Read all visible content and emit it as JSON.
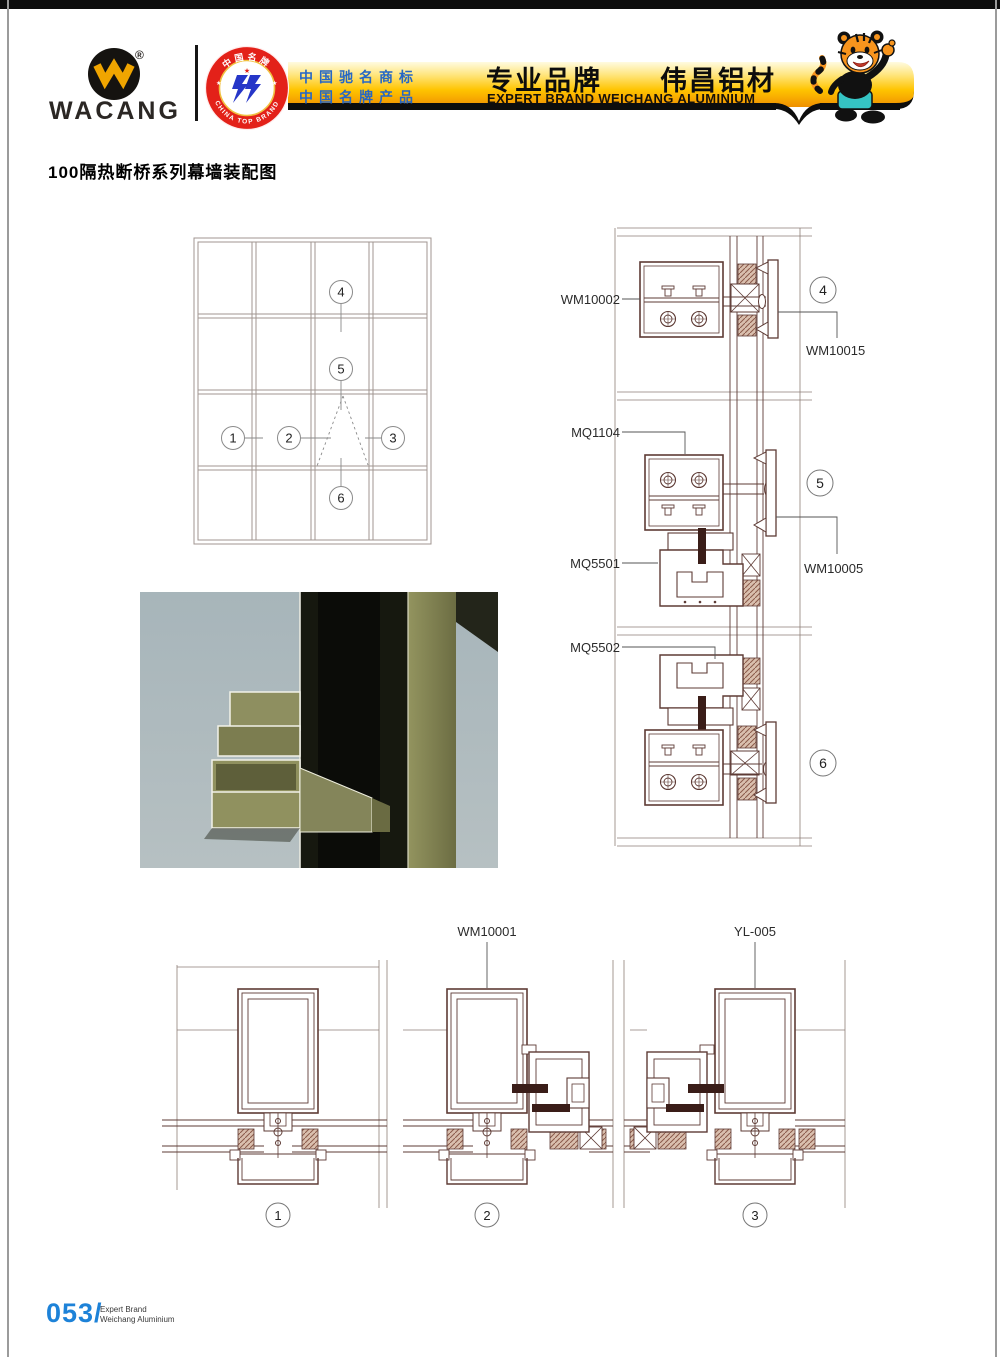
{
  "header": {
    "brand": "WACANG",
    "registered_mark": "®",
    "badge": {
      "arc_top": "中国名牌",
      "arc_bottom": "CHINA TOP BRAND"
    },
    "banner": {
      "trademark_line1": "中国驰名商标",
      "trademark_line2": "中国名牌产品",
      "slogan_cn": "专业品牌　　伟昌铝材",
      "slogan_en": "EXPERT BRAND WEICHANG ALUMINIUM"
    },
    "colors": {
      "banner_gold": "#ffc400",
      "badge_red": "#e32119",
      "trademark_blue": "#2667c5"
    }
  },
  "title": "100隔热断桥系列幕墙装配图",
  "elevation": {
    "callouts": {
      "c1": "1",
      "c2": "2",
      "c3": "3",
      "c4": "4",
      "c5": "5",
      "c6": "6"
    }
  },
  "right_details": {
    "labels": {
      "wm10002": "WM10002",
      "wm10015": "WM10015",
      "mq1104": "MQ1104",
      "mq5501": "MQ5501",
      "wm10005": "WM10005",
      "mq5502": "MQ5502"
    },
    "callouts": {
      "top": "4",
      "middle": "5",
      "bottom": "6"
    }
  },
  "bottom_details": {
    "labels": {
      "wm10001": "WM10001",
      "yl005": "YL-005"
    },
    "callouts": {
      "left": "1",
      "middle": "2",
      "right": "3"
    }
  },
  "footer": {
    "page_number": "053/",
    "caption_line1": "Expert Brand",
    "caption_line2": "Weichang Aluminium"
  }
}
